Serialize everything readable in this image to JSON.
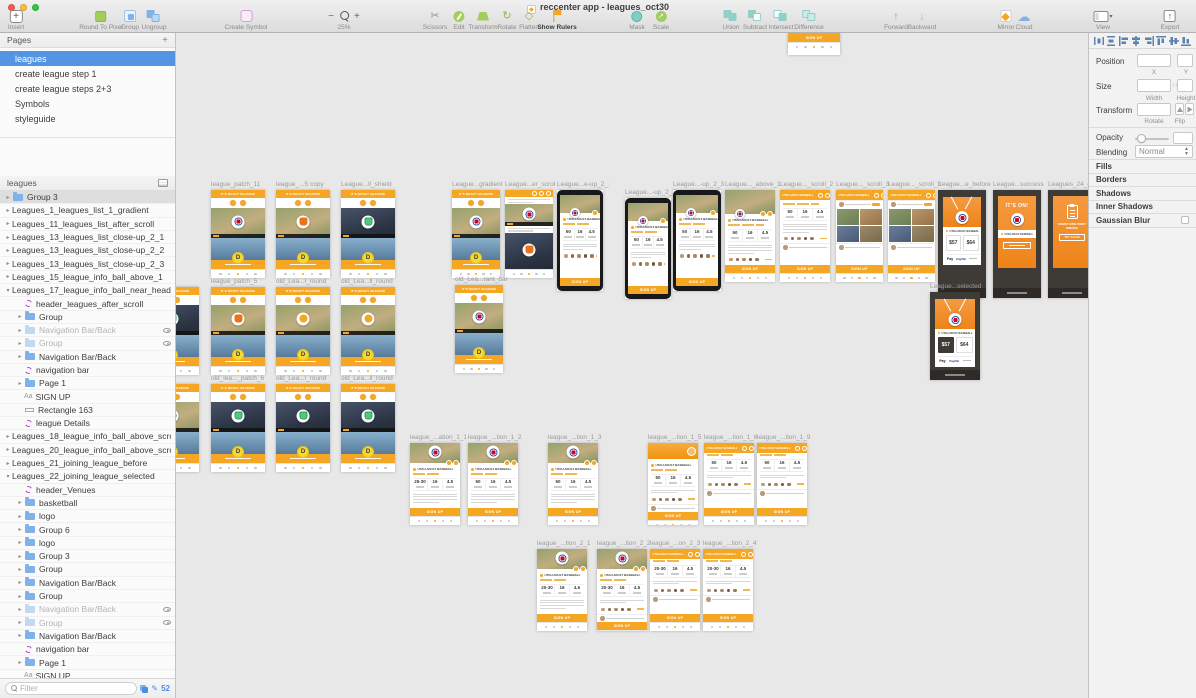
{
  "window": {
    "title": "reccenter app - leagues_oct30"
  },
  "toolbar": {
    "items": [
      {
        "name": "insert",
        "label": "Insert"
      },
      {
        "name": "round-to-pixel",
        "label": "Round To Pixel"
      },
      {
        "name": "group",
        "label": "Group"
      },
      {
        "name": "ungroup",
        "label": "Ungroup"
      },
      {
        "name": "create-symbol",
        "label": "Create Symbol"
      },
      {
        "name": "scissors",
        "label": "Scissors"
      },
      {
        "name": "edit",
        "label": "Edit"
      },
      {
        "name": "transform",
        "label": "Transform"
      },
      {
        "name": "rotate",
        "label": "Rotate"
      },
      {
        "name": "flatten",
        "label": "Flatten"
      },
      {
        "name": "show-rulers",
        "label": "Show Rulers",
        "active": true
      },
      {
        "name": "mask",
        "label": "Mask"
      },
      {
        "name": "scale",
        "label": "Scale"
      },
      {
        "name": "union",
        "label": "Union"
      },
      {
        "name": "subtract",
        "label": "Subtract"
      },
      {
        "name": "intersect",
        "label": "Intersect"
      },
      {
        "name": "difference",
        "label": "Difference"
      },
      {
        "name": "forward",
        "label": "Forward"
      },
      {
        "name": "backward",
        "label": "Backward"
      },
      {
        "name": "mirror",
        "label": "Mirror"
      },
      {
        "name": "cloud",
        "label": "Cloud"
      },
      {
        "name": "view",
        "label": "View"
      },
      {
        "name": "export",
        "label": "Export"
      }
    ],
    "zoom": {
      "minus": "−",
      "plus": "+",
      "level": "25%"
    }
  },
  "pages_panel": {
    "title": "Pages",
    "add_label": "+",
    "items": [
      {
        "label": "leagues",
        "selected": true
      },
      {
        "label": "create league step 1"
      },
      {
        "label": "create league steps 2+3"
      },
      {
        "label": "Symbols"
      },
      {
        "label": "styleguide"
      }
    ]
  },
  "layers_panel": {
    "title": "leagues",
    "rows": [
      {
        "label": "Group 3",
        "t": "folder",
        "d": 0,
        "shaded": true
      },
      {
        "label": "Leagues_1_leagues_list_1_gradient",
        "t": "artboard",
        "d": 0
      },
      {
        "label": "Leagues_11_leagues_list_after_scroll",
        "t": "artboard",
        "d": 0
      },
      {
        "label": "Leagues_13_leagues_list_close-up_2_1",
        "t": "artboard",
        "d": 0
      },
      {
        "label": "Leagues_13_leagues_list_close-up_2_2",
        "t": "artboard",
        "d": 0
      },
      {
        "label": "Leagues_13_leagues_list_close-up_2_3",
        "t": "artboard",
        "d": 0
      },
      {
        "label": "Leagues_15_league_info_ball_above_1",
        "t": "artboard",
        "d": 0
      },
      {
        "label": "Leagues_17_league_info_ball_near_headline_scroll_2",
        "t": "artboard",
        "d": 0,
        "exp": true
      },
      {
        "label": "header_leagues_after_scroll",
        "t": "symbol",
        "d": 1
      },
      {
        "label": "Group",
        "t": "folder",
        "d": 1
      },
      {
        "label": "Navigation Bar/Back",
        "t": "folder",
        "d": 1,
        "hidden": true
      },
      {
        "label": "Group",
        "t": "folder",
        "d": 1,
        "hidden": true
      },
      {
        "label": "Navigation Bar/Back",
        "t": "folder",
        "d": 1
      },
      {
        "label": "navigation bar",
        "t": "symbol",
        "d": 1
      },
      {
        "label": "Page 1",
        "t": "folder",
        "d": 1
      },
      {
        "label": "SIGN UP",
        "t": "text",
        "d": 1
      },
      {
        "label": "Rectangle 163",
        "t": "rect",
        "d": 1
      },
      {
        "label": "league Details",
        "t": "symbol",
        "d": 1
      },
      {
        "label": "Leagues_18_league_info_ball_above_scroll_3",
        "t": "artboard",
        "d": 0
      },
      {
        "label": "Leagues_20_league_info_ball_above_scroll_3",
        "t": "artboard",
        "d": 0
      },
      {
        "label": "Leagues_21_joining_league_before",
        "t": "artboard",
        "d": 0
      },
      {
        "label": "Leagues_22_joining_league_selected",
        "t": "artboard",
        "d": 0,
        "exp": true
      },
      {
        "label": "header_Venues",
        "t": "symbol",
        "d": 1
      },
      {
        "label": "basketball",
        "t": "folder",
        "d": 1
      },
      {
        "label": "logo",
        "t": "folder",
        "d": 1
      },
      {
        "label": "Group 6",
        "t": "folder",
        "d": 1
      },
      {
        "label": "logo",
        "t": "folder",
        "d": 1
      },
      {
        "label": "Group 3",
        "t": "folder",
        "d": 1
      },
      {
        "label": "Group",
        "t": "folder",
        "d": 1
      },
      {
        "label": "Navigation Bar/Back",
        "t": "folder",
        "d": 1
      },
      {
        "label": "Group",
        "t": "folder",
        "d": 1
      },
      {
        "label": "Navigation Bar/Back",
        "t": "folder",
        "d": 1,
        "hidden": true
      },
      {
        "label": "Group",
        "t": "folder",
        "d": 1,
        "hidden": true
      },
      {
        "label": "Navigation Bar/Back",
        "t": "folder",
        "d": 1
      },
      {
        "label": "navigation bar",
        "t": "symbol",
        "d": 1
      },
      {
        "label": "Page 1",
        "t": "folder",
        "d": 1
      },
      {
        "label": "SIGN UP",
        "t": "text",
        "d": 1
      },
      {
        "label": "Rectangle 163",
        "t": "rect",
        "d": 1
      }
    ]
  },
  "filter_bar": {
    "placeholder": "Filter",
    "count": "52"
  },
  "inspector": {
    "align_icons": [
      "distribute-horizontally",
      "distribute-vertically",
      "align-left",
      "align-center-horizontal",
      "align-right",
      "align-top",
      "align-middle",
      "align-bottom"
    ],
    "position_label": "Position",
    "x_caption": "X",
    "y_caption": "Y",
    "size_label": "Size",
    "width_caption": "Width",
    "height_caption": "Height",
    "transform_label": "Transform",
    "rotate_caption": "Rotate",
    "flip_caption": "Flip",
    "opacity_label": "Opacity",
    "blending_label": "Blending",
    "blending_value": "Normal",
    "sections": [
      "Fills",
      "Borders",
      "Shadows",
      "Inner Shadows"
    ],
    "gaussian_blur_label": "Gaussian Blur"
  },
  "canvas": {
    "mini": {
      "feed_header": "IT'S DRAFT SEASON!",
      "team": "UTAH ADULT BASEBALL",
      "sign_up": "SIGN UP",
      "its_on": "IT'S ON!",
      "error_title": "SOMETHING WENT WRONG",
      "try_again": "TRY AGAIN",
      "price_left": "$57",
      "price_right": "$64",
      "apple_pay": "Pay",
      "paypal": "PayPal",
      "coin_letter": "D",
      "stats_a": [
        "25-30",
        "16",
        "4.5"
      ],
      "stats_b": [
        "50",
        "16",
        "4.5"
      ],
      "stats_c": [
        "20-30",
        "16",
        "4.5"
      ]
    },
    "artboards": [
      {
        "label": "league_patch_11",
        "x": 35,
        "y": 157,
        "w": 54,
        "h": 88,
        "v": "feed",
        "photo": "bb",
        "badge": "rb"
      },
      {
        "label": "league_...5 copy",
        "x": 100,
        "y": 157,
        "w": 54,
        "h": 88,
        "v": "feed",
        "photo": "bb",
        "badge": "or"
      },
      {
        "label": "League...ll_shield",
        "x": 165,
        "y": 157,
        "w": 54,
        "h": 88,
        "v": "feed",
        "photo": "fb",
        "badge": "gr"
      },
      {
        "label": "...l_shield",
        "x": -31,
        "y": 254,
        "w": 54,
        "h": 88,
        "v": "feed",
        "photo": "fb",
        "badge": "gr"
      },
      {
        "label": "league_patch_5",
        "x": 35,
        "y": 254,
        "w": 54,
        "h": 88,
        "v": "feed",
        "photo": "bb",
        "badge": "or"
      },
      {
        "label": "old_Lea...l_round",
        "x": 100,
        "y": 254,
        "w": 54,
        "h": 88,
        "v": "feed",
        "photo": "bb",
        "badge": "orc"
      },
      {
        "label": "old_Lea...ll_round",
        "x": 165,
        "y": 254,
        "w": 54,
        "h": 88,
        "v": "feed",
        "photo": "bb",
        "badge": "orc"
      },
      {
        "label": "...gue_list",
        "x": -31,
        "y": 351,
        "w": 54,
        "h": 88,
        "v": "feed",
        "photo": "bb",
        "badge": "rb"
      },
      {
        "label": "old_lea..._patch_6",
        "x": 35,
        "y": 351,
        "w": 54,
        "h": 88,
        "v": "feed",
        "photo": "fb",
        "badge": "gr"
      },
      {
        "label": "old_Lea...l_round",
        "x": 100,
        "y": 351,
        "w": 54,
        "h": 88,
        "v": "feed",
        "photo": "fb",
        "badge": "gr"
      },
      {
        "label": "old_Lea...ll_round",
        "x": 165,
        "y": 351,
        "w": 54,
        "h": 88,
        "v": "feed",
        "photo": "fb",
        "badge": "gr"
      },
      {
        "label": "League...gradient",
        "x": 276,
        "y": 157,
        "w": 48,
        "h": 88,
        "v": "feed",
        "photo": "bb",
        "badge": "rb"
      },
      {
        "label": "League...er_scrol",
        "x": 329,
        "y": 157,
        "w": 48,
        "h": 88,
        "v": "feed2"
      },
      {
        "label": "League...e-up_2_1",
        "x": 381,
        "y": 157,
        "w": 46,
        "h": 101,
        "v": "framed"
      },
      {
        "label": "League...-up_2_2",
        "x": 449,
        "y": 165,
        "w": 46,
        "h": 101,
        "v": "framed"
      },
      {
        "label": "League...-up_2_3",
        "x": 497,
        "y": 157,
        "w": 48,
        "h": 101,
        "v": "framed"
      },
      {
        "label": "League..._above_1",
        "x": 549,
        "y": 157,
        "w": 50,
        "h": 92,
        "v": "info"
      },
      {
        "label": "League..._scroll_2",
        "x": 604,
        "y": 157,
        "w": 50,
        "h": 92,
        "v": "infoScroll"
      },
      {
        "label": "League..._scroll_3",
        "x": 660,
        "y": 157,
        "w": 47,
        "h": 92,
        "v": "infoScroll3"
      },
      {
        "label": "League..._scroll_3",
        "x": 712,
        "y": 157,
        "w": 47,
        "h": 92,
        "v": "infoScroll3"
      },
      {
        "label": "League...e_before",
        "x": 762,
        "y": 157,
        "w": 48,
        "h": 108,
        "v": "checkout",
        "sel": false
      },
      {
        "label": "League...success",
        "x": 817,
        "y": 157,
        "w": 48,
        "h": 108,
        "v": "success"
      },
      {
        "label": "Leagues_24_error",
        "x": 872,
        "y": 157,
        "w": 48,
        "h": 108,
        "v": "error"
      },
      {
        "label": "old_Lea...rant_bar",
        "x": 279,
        "y": 252,
        "w": 48,
        "h": 88,
        "v": "feed",
        "photo": "bb",
        "badge": "rb"
      },
      {
        "label": "League...selected",
        "x": 754,
        "y": 259,
        "w": 50,
        "h": 88,
        "v": "checkout",
        "sel": true
      },
      {
        "label": "league_...ation_1_1",
        "x": 234,
        "y": 410,
        "w": 50,
        "h": 82,
        "v": "detail",
        "header": "photo",
        "stats": "a",
        "people": false
      },
      {
        "label": "league_...tion_1_2",
        "x": 292,
        "y": 410,
        "w": 50,
        "h": 82,
        "v": "detail",
        "header": "photo",
        "stats": "b",
        "people": false
      },
      {
        "label": "league_...tion_1_3",
        "x": 372,
        "y": 410,
        "w": 50,
        "h": 82,
        "v": "detail",
        "header": "photo",
        "stats": "b",
        "people": false
      },
      {
        "label": "league_...tion_1_5",
        "x": 472,
        "y": 410,
        "w": 50,
        "h": 82,
        "v": "detail",
        "header": "tex",
        "stats": "b",
        "people": true
      },
      {
        "label": "league_...tion_1_8",
        "x": 528,
        "y": 410,
        "w": 50,
        "h": 82,
        "v": "detail",
        "header": "bar",
        "stats": "b",
        "people": true
      },
      {
        "label": "league_...tion_1_9",
        "x": 581,
        "y": 410,
        "w": 50,
        "h": 82,
        "v": "detail",
        "header": "bar",
        "stats": "b",
        "people": true
      },
      {
        "label": "league_...tion_2_1",
        "x": 361,
        "y": 516,
        "w": 50,
        "h": 82,
        "v": "detail",
        "header": "photo",
        "stats": "c",
        "people": false
      },
      {
        "label": "league_...tion_2_2",
        "x": 421,
        "y": 516,
        "w": 50,
        "h": 82,
        "v": "detail",
        "header": "photo",
        "stats": "c",
        "people": true
      },
      {
        "label": "league_...on_2_3",
        "x": 474,
        "y": 516,
        "w": 50,
        "h": 82,
        "v": "detail",
        "header": "bar",
        "stats": "c",
        "people": true
      },
      {
        "label": "league_...tion_2_4",
        "x": 527,
        "y": 516,
        "w": 50,
        "h": 82,
        "v": "detail",
        "header": "bar",
        "stats": "c",
        "people": true
      },
      {
        "label": "",
        "x": 612,
        "y": 0,
        "w": 52,
        "h": 22,
        "v": "bottombar"
      }
    ]
  },
  "colors": {
    "orange": "#F5A623",
    "yellow": "#F7D832",
    "selection_blue": "#5494E4",
    "canvas_gray": "#E8E8E8",
    "dark_bg": "#3E3A36",
    "phone_frame": "#191919",
    "badge_red": "#D0021B",
    "badge_navy": "#2A4D9B",
    "badge_green": "#52C784",
    "paypal_blue": "#253B80",
    "accent_blue": "#4A90E2"
  }
}
